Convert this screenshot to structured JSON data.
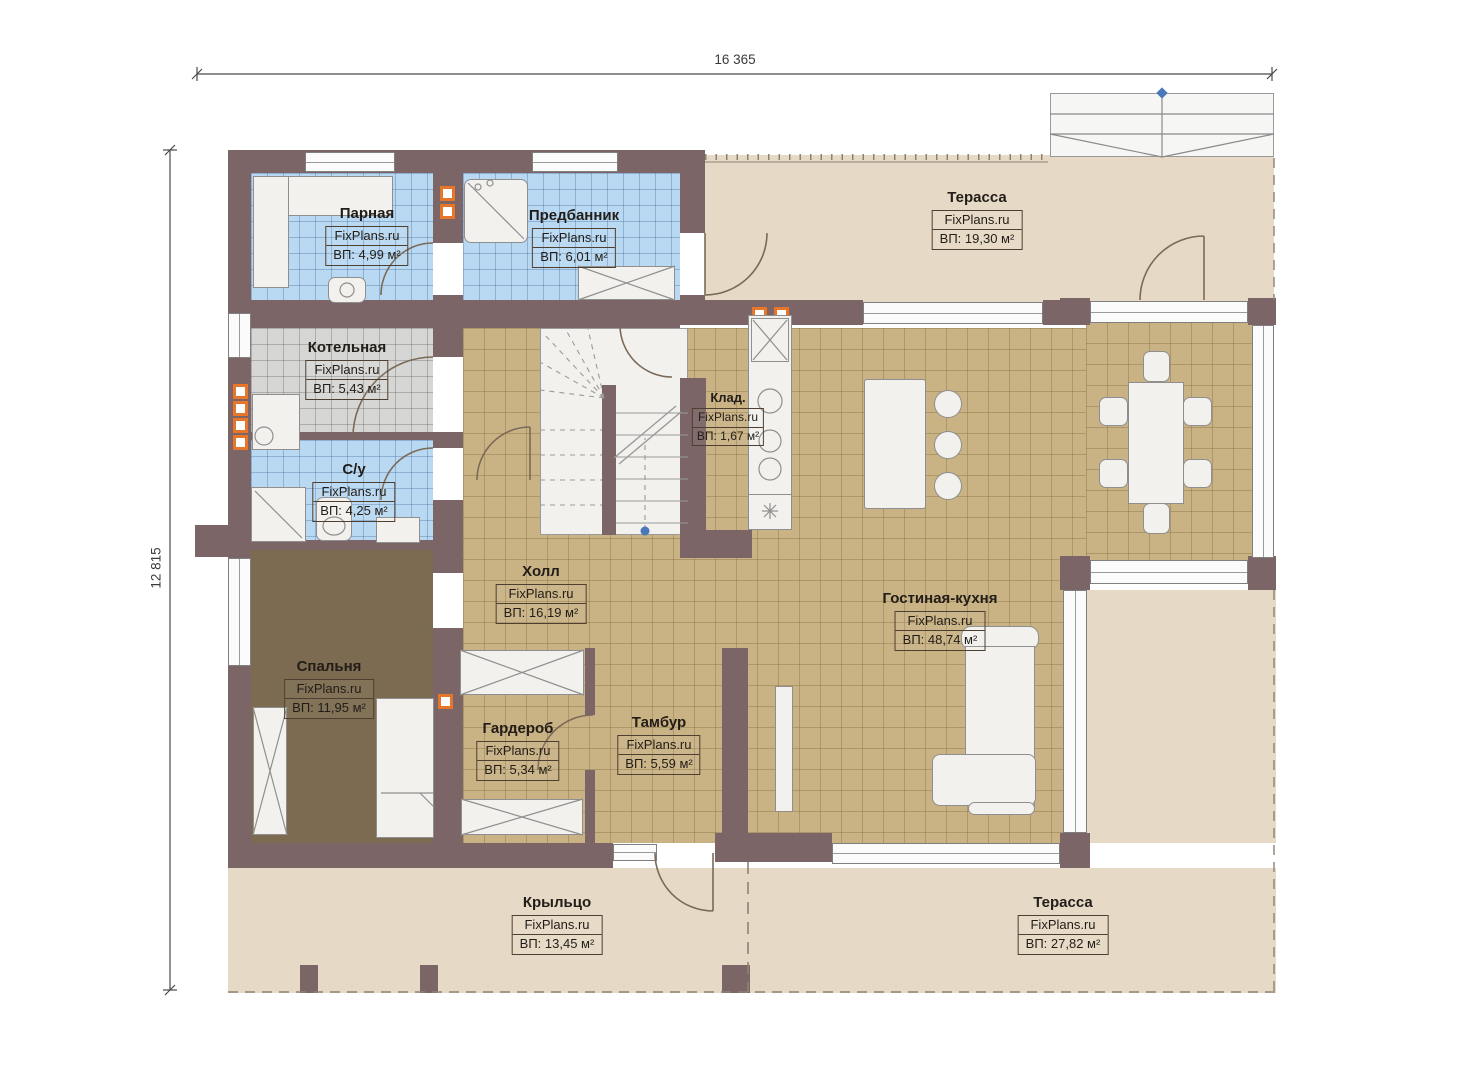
{
  "plan": {
    "dimension_top": "16 365",
    "dimension_left": "12 815",
    "rooms": [
      {
        "name": "Парная",
        "brand": "FixPlans.ru",
        "area": "ВП: 4,99 м²"
      },
      {
        "name": "Предбанник",
        "brand": "FixPlans.ru",
        "area": "ВП: 6,01 м²"
      },
      {
        "name": "Терасса",
        "brand": "FixPlans.ru",
        "area": "ВП: 19,30 м²"
      },
      {
        "name": "Котельная",
        "brand": "FixPlans.ru",
        "area": "ВП: 5,43 м²"
      },
      {
        "name": "Клад.",
        "brand": "FixPlans.ru",
        "area": "ВП: 1,67 м²"
      },
      {
        "name": "С/у",
        "brand": "FixPlans.ru",
        "area": "ВП: 4,25 м²"
      },
      {
        "name": "Холл",
        "brand": "FixPlans.ru",
        "area": "ВП: 16,19 м²"
      },
      {
        "name": "Гостиная-кухня",
        "brand": "FixPlans.ru",
        "area": "ВП: 48,74 м²"
      },
      {
        "name": "Спальня",
        "brand": "FixPlans.ru",
        "area": "ВП: 11,95 м²"
      },
      {
        "name": "Гардероб",
        "brand": "FixPlans.ru",
        "area": "ВП: 5,34 м²"
      },
      {
        "name": "Тамбур",
        "brand": "FixPlans.ru",
        "area": "ВП: 5,59 м²"
      },
      {
        "name": "Крыльцо",
        "brand": "FixPlans.ru",
        "area": "ВП: 13,45 м²"
      },
      {
        "name": "Терасса",
        "brand": "FixPlans.ru",
        "area": "ВП: 27,82 м²"
      }
    ],
    "colors": {
      "wall": "#7b6566",
      "tile_tan": "#c9b284",
      "tile_blue": "#b9d8f1",
      "tile_gray": "#d6d6d4",
      "carpet": "#7c6b50",
      "terrace": "#e6dac6",
      "vent_orange": "#e8762a",
      "marker_blue": "#4a78b8"
    }
  }
}
